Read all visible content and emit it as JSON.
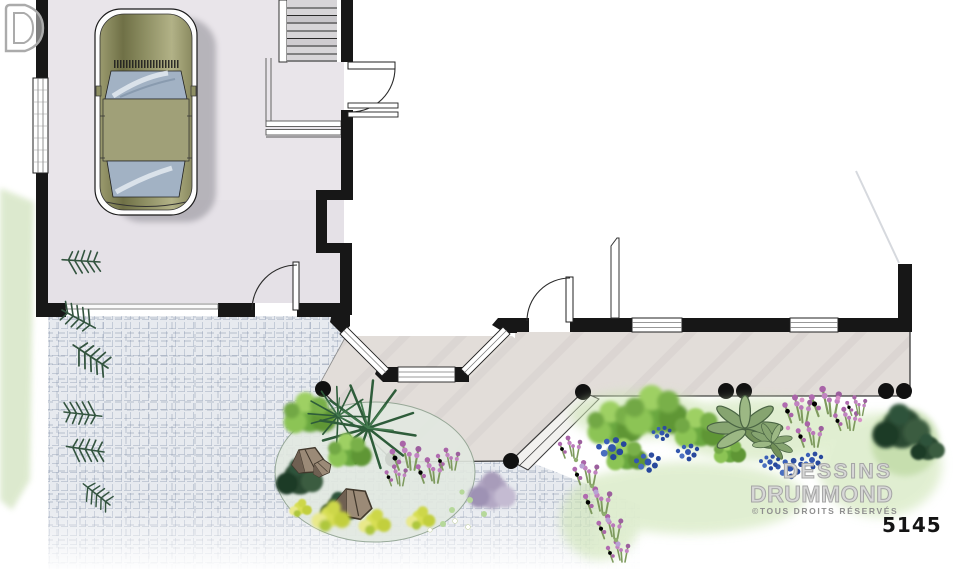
{
  "page": {
    "background": "#ffffff"
  },
  "watermark": {
    "brand_line1": "DESSINS",
    "brand_line2": "DRUMMOND",
    "logo_icon": "drummond-d-logo",
    "rights_notice": "©TOUS DROITS RÉSERVÉS"
  },
  "plan_number": "5145",
  "palette": {
    "wall_black": "#171717",
    "garage_floor": "#e9e5ea",
    "porch_floor": "#e2ddd9",
    "paving_line_blue_gray": "#7e8aa0",
    "car_body_olive": "#8a8a5e",
    "car_glass_blue": "#a2b2c4",
    "foliage_green": "#7fb449",
    "foliage_dark_green": "#2c4a33",
    "flower_blue": "#3356ae",
    "flower_purple": "#a964a8",
    "flower_yellow": "#d8df54",
    "lawn_green": "#cde4b4",
    "watermark_gray": "#a6a6a6"
  }
}
